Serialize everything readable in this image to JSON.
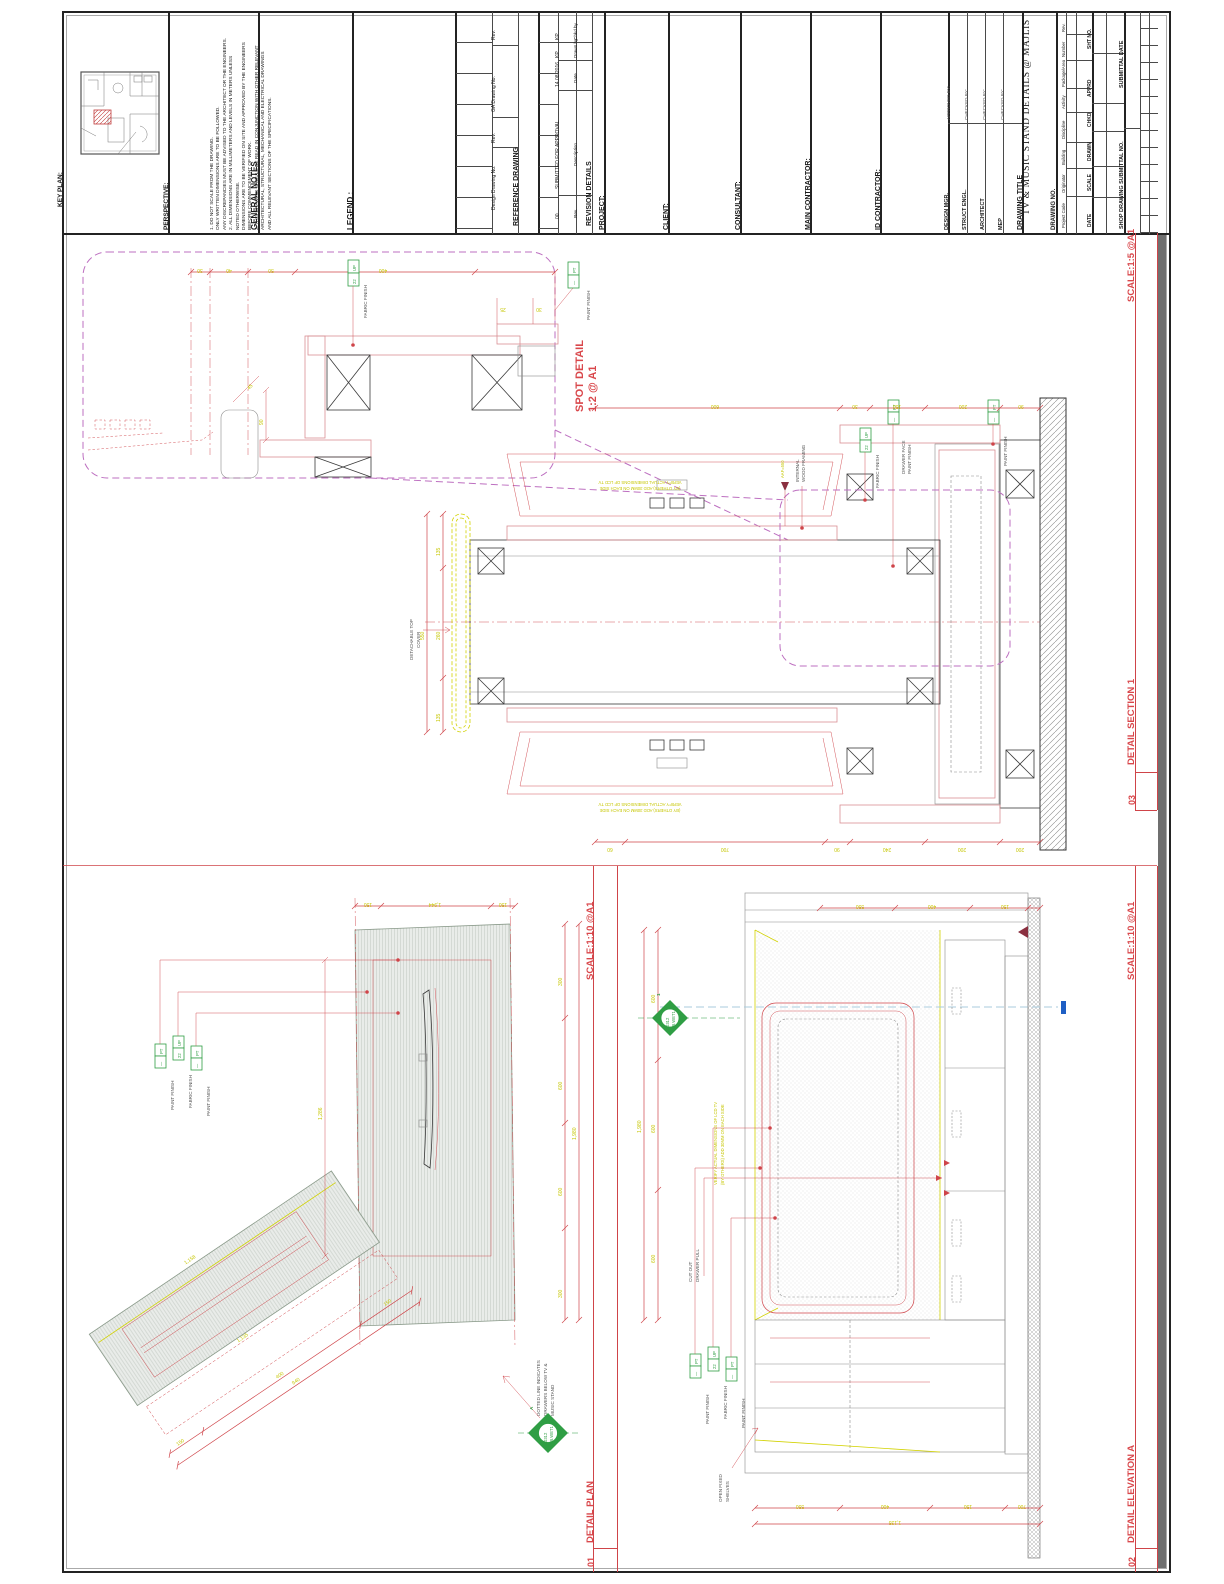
{
  "titleblock": {
    "key_plan_label": "KEY PLAN:",
    "perspective_label": "PERSPECTIVE:",
    "general_notes": {
      "title": "GENERAL NOTES",
      "body": "1.  DO NOT SCALE FROM THE DRAWING.\n     ONLY WRITTEN DIMENSIONS ARE TO BE FOLLOWED.\n     ANY DISCREPANCIES MUST BE ADVISED TO THE ARCHITECT OR THE ENGINEERS.\n2.  ALL DIMENSIONS ARE IN MILLIMETERS AND LEVELS IN METERS UNLESS\n     NOTED OTHERWISE.\n     DIMENSIONS ARE TO BE VERIFIED ON SITE AND APPROVED BY THE ENGINEERS\n     BEFORE COMMENCEMENT OF WORK.\n3.  THIS DRAWING SHOULD BE READ IN CONJUNCTION WITH OTHER RELEVANT\n     ARCHITECTURAL, STRUCTURAL, MECHANICAL AND ELECTRICAL DRAWINGS\n     AND ALL RELEVANT SECTIONS OF THE SPECIFICATIONS."
    },
    "legend_label": "LEGEND :",
    "reference_drawing": {
      "title": "REFERENCE DRAWING",
      "col_design": "Design Drawing No.",
      "col_rev1": "Rev.",
      "col_ga": "GA Drawing No.",
      "col_rev2": "Rev."
    },
    "revision": {
      "title": "REVISION DETAILS",
      "hdr_rev": "Rev.",
      "hdr_desc": "Description",
      "hdr_date": "Date",
      "hdr_drawn": "Drawn by",
      "hdr_chkd": "Chkd by",
      "row_rev": "00",
      "row_desc": "SUBMITTED FOR APPROVAL",
      "row_date": "14.08.2016",
      "row_drawn": "KP",
      "row_chkd": "KP"
    },
    "project_label": "PROJECT:",
    "client_label": "CLIENT:",
    "consultant_label": "CONSULTANT:",
    "main_contractor_label": "MAIN CONTRACTOR:",
    "id_contractor_label": "ID CONTRACTOR:",
    "approvals": {
      "role_0": "DESIGN MGR.",
      "by_0": "APPROVED  BY:",
      "role_1": "STRUCT ENGL.",
      "by_1": "CHECKED  BY:",
      "role_2": "ARCHITECT",
      "by_2": "CHECKED  BY:",
      "role_3": "MEP",
      "by_3": "CHECKED  BY:"
    },
    "drawing_title_label": "DRAWING TITLE",
    "drawing_title": "TV & MUSIC STAND DETAILS @ MAJLIS",
    "drawing_no_label": "DRAWING NO.",
    "drawing_no_cols": [
      "Project Code",
      "Originator",
      "Building",
      "Discipline",
      "Activity",
      "Package/Area",
      "Number",
      "Rev."
    ],
    "meta_cols": [
      "DATE",
      "SCALE",
      "DRAWN",
      "CHKD",
      "APPRD",
      "SHT NO."
    ],
    "shop_submittal_label": "SHOP DRAWING SUBMITTAL NO.",
    "submittal_date_label": "SUBMITTAL DATE"
  },
  "views": {
    "spot": {
      "title": "SPOT DETAIL",
      "scale": "1:2 @ A1"
    },
    "section": {
      "no": "03",
      "title": "DETAIL SECTION 1",
      "scale": "SCALE:1:5 @A1"
    },
    "plan": {
      "no": "01",
      "title": "DETAIL PLAN",
      "scale": "SCALE:1:10 @A1"
    },
    "elevation": {
      "no": "02",
      "title": "DETAIL ELEVATION A",
      "scale": "SCALE:1:10 @A1"
    }
  },
  "fin": {
    "pt": "PT",
    "dash": "—",
    "up": "UP",
    "up_num": "22",
    "paint": "PAINT FINISH",
    "fabric": "FABRIC FINISH",
    "drawer_face_1": "DRAWER FACE",
    "drawer_face_2": "PAINT FINISH"
  },
  "ann": {
    "internal_1": "INTERNAL",
    "internal_2": "WOOD FRAMING",
    "detachable_1": "DETACHABLE TOP",
    "detachable_2": "COVER",
    "cutout_1": "CUT OUT",
    "cutout_2": "DRAWER PULL",
    "shelves_1": "OPEN FIXED",
    "shelves_2": "SHELVES",
    "dotted_1": "DOTTED LINE INDICATES",
    "dotted_2": "DRAWERS BELOW TV &",
    "dotted_3": "MUSIC STAND",
    "verify_1": "VERIFY ACTUAL DIMENSIONS OF LCD TV",
    "verify_2": "(BY OTHERS) ADD 30MM ON EACH SIDE",
    "level_marker": "AAF=550",
    "ref_code": "0312",
    "ref_sheet": "2B.WET1",
    "ref_elev_letter": "A",
    "ref_section_number": "1"
  },
  "dims": {
    "spot_top": [
      "30",
      "40",
      "50",
      "400"
    ],
    "spot_misc": [
      "90",
      "25",
      "30",
      "45"
    ],
    "section_top": [
      "600",
      "30",
      "150",
      "200",
      "90"
    ],
    "section_bottom": [
      "60",
      "700",
      "90",
      "240",
      "200",
      "200"
    ],
    "section_left": [
      "135",
      "260",
      "135",
      "550"
    ],
    "plan_top": [
      "150",
      "1,944",
      "150"
    ],
    "plan_right": [
      "300",
      "600",
      "600",
      "300",
      "1,980"
    ],
    "plan_angled": [
      "150",
      "400",
      "150",
      "940",
      "1,158"
    ],
    "plan_inner": [
      "1,286",
      "1,135"
    ],
    "elev_top": [
      "550",
      "400",
      "150"
    ],
    "elev_bottom": [
      "550",
      "400",
      "150",
      "700",
      "1,135"
    ],
    "elev_left": [
      "600",
      "600",
      "600",
      "1,980"
    ]
  },
  "colors": {
    "cad_red": "#cf4449",
    "cad_yellow": "#c6c600",
    "cad_green": "#2f9e44",
    "detail_magenta": "#bd6fc0"
  }
}
